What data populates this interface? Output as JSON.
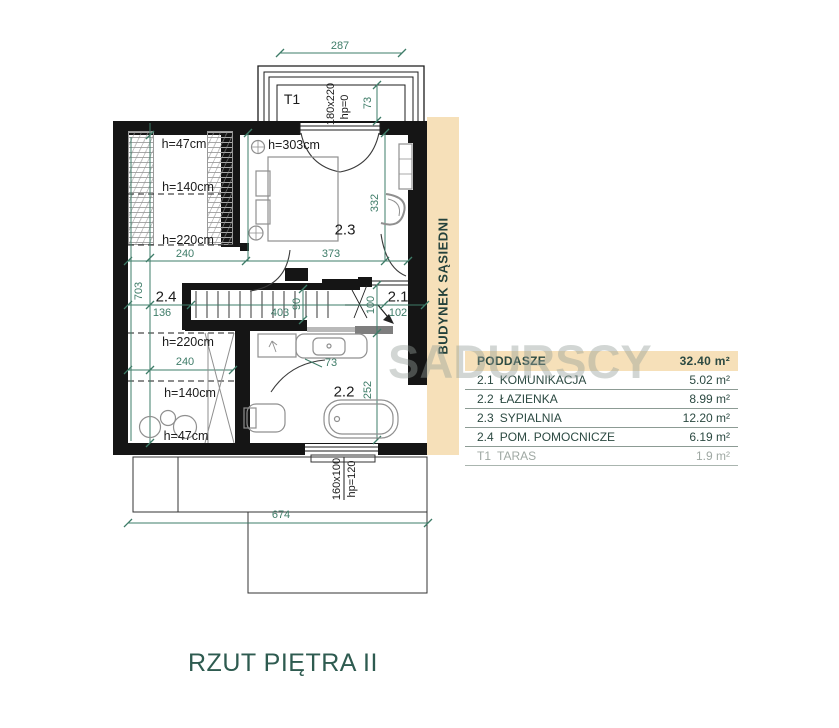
{
  "title": "RZUT PIĘTRA II",
  "watermark": "SADURSCY",
  "neighbor_building_label": "BUDYNEK SĄSIEDNI",
  "legend": {
    "header": {
      "name": "PODDASZE",
      "area": "32.40 m²"
    },
    "rows": [
      {
        "id": "2.1",
        "name": "KOMUNIKACJA",
        "area": "5.02 m²"
      },
      {
        "id": "2.2",
        "name": "ŁAZIENKA",
        "area": "8.99 m²"
      },
      {
        "id": "2.3",
        "name": "SYPIALNIA",
        "area": "12.20 m²"
      },
      {
        "id": "2.4",
        "name": "POM. POMOCNICZE",
        "area": "6.19 m²"
      },
      {
        "id": "T1",
        "name": "TARAS",
        "area": "1.9 m²"
      }
    ]
  },
  "annotations": {
    "dim_terrace_width": "287",
    "terrace_label": "T1",
    "terrace_window_size": "180x220",
    "terrace_window_sill": "hp=0",
    "dim_terrace_depth": "73",
    "h47_top": "h=47cm",
    "h140_top": "h=140cm",
    "h220_top": "h=220cm",
    "dim_240_top": "240",
    "h303_bedroom": "h=303cm",
    "room_23": "2.3",
    "dim_373": "373",
    "dim_332": "332",
    "dim_703": "703",
    "room_24": "2.4",
    "dim_136": "136",
    "dim_403": "403",
    "dim_90": "90",
    "dim_100": "100",
    "room_21": "2.1",
    "dim_102": "102",
    "h220_bottom": "h=220cm",
    "dim_240_bottom": "240",
    "h140_bottom": "h=140cm",
    "h47_bottom": "h=47cm",
    "dim_73_bath": "73",
    "room_22": "2.2",
    "dim_252": "252",
    "bath_window_size": "160x100",
    "bath_window_sill": "hp=120",
    "dim_674": "674"
  }
}
